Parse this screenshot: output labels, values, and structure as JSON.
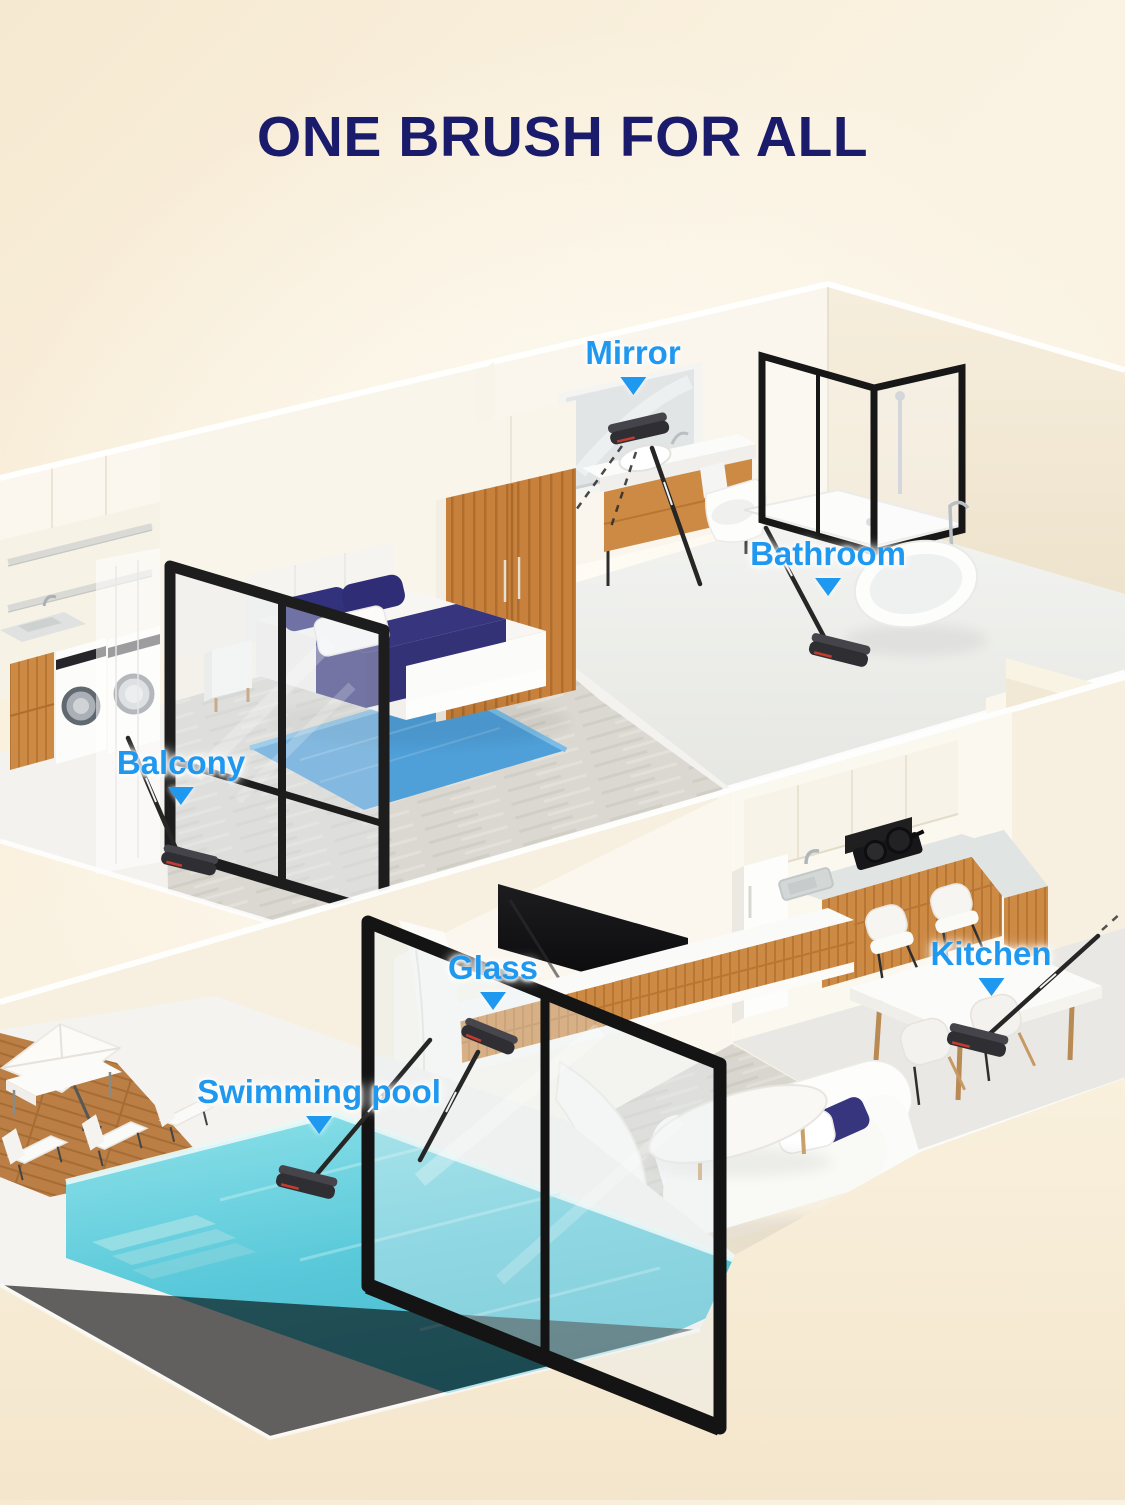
{
  "title": "ONE BRUSH FOR ALL",
  "labels": [
    {
      "id": "mirror",
      "text": "Mirror"
    },
    {
      "id": "bathroom",
      "text": "Bathroom"
    },
    {
      "id": "balcony",
      "text": "Balcony"
    },
    {
      "id": "glass",
      "text": "Glass"
    },
    {
      "id": "kitchen",
      "text": "Kitchen"
    },
    {
      "id": "swimming_pool",
      "text": "Swimming pool"
    }
  ],
  "colors": {
    "title_navy": "#1b1b6b",
    "label_blue": "#1f98f0",
    "background_cream": "#f8edd8",
    "wall_white": "#faf6ed",
    "wall_warm": "#f1e8d5",
    "wood_accent": "#c9823d",
    "floor_wood": "#dbd8d1",
    "rug_blue": "#4f9fd8",
    "bedding_navy": "#37357e",
    "pool_water": "#5ac9da",
    "frame_black": "#1d1d1d"
  }
}
